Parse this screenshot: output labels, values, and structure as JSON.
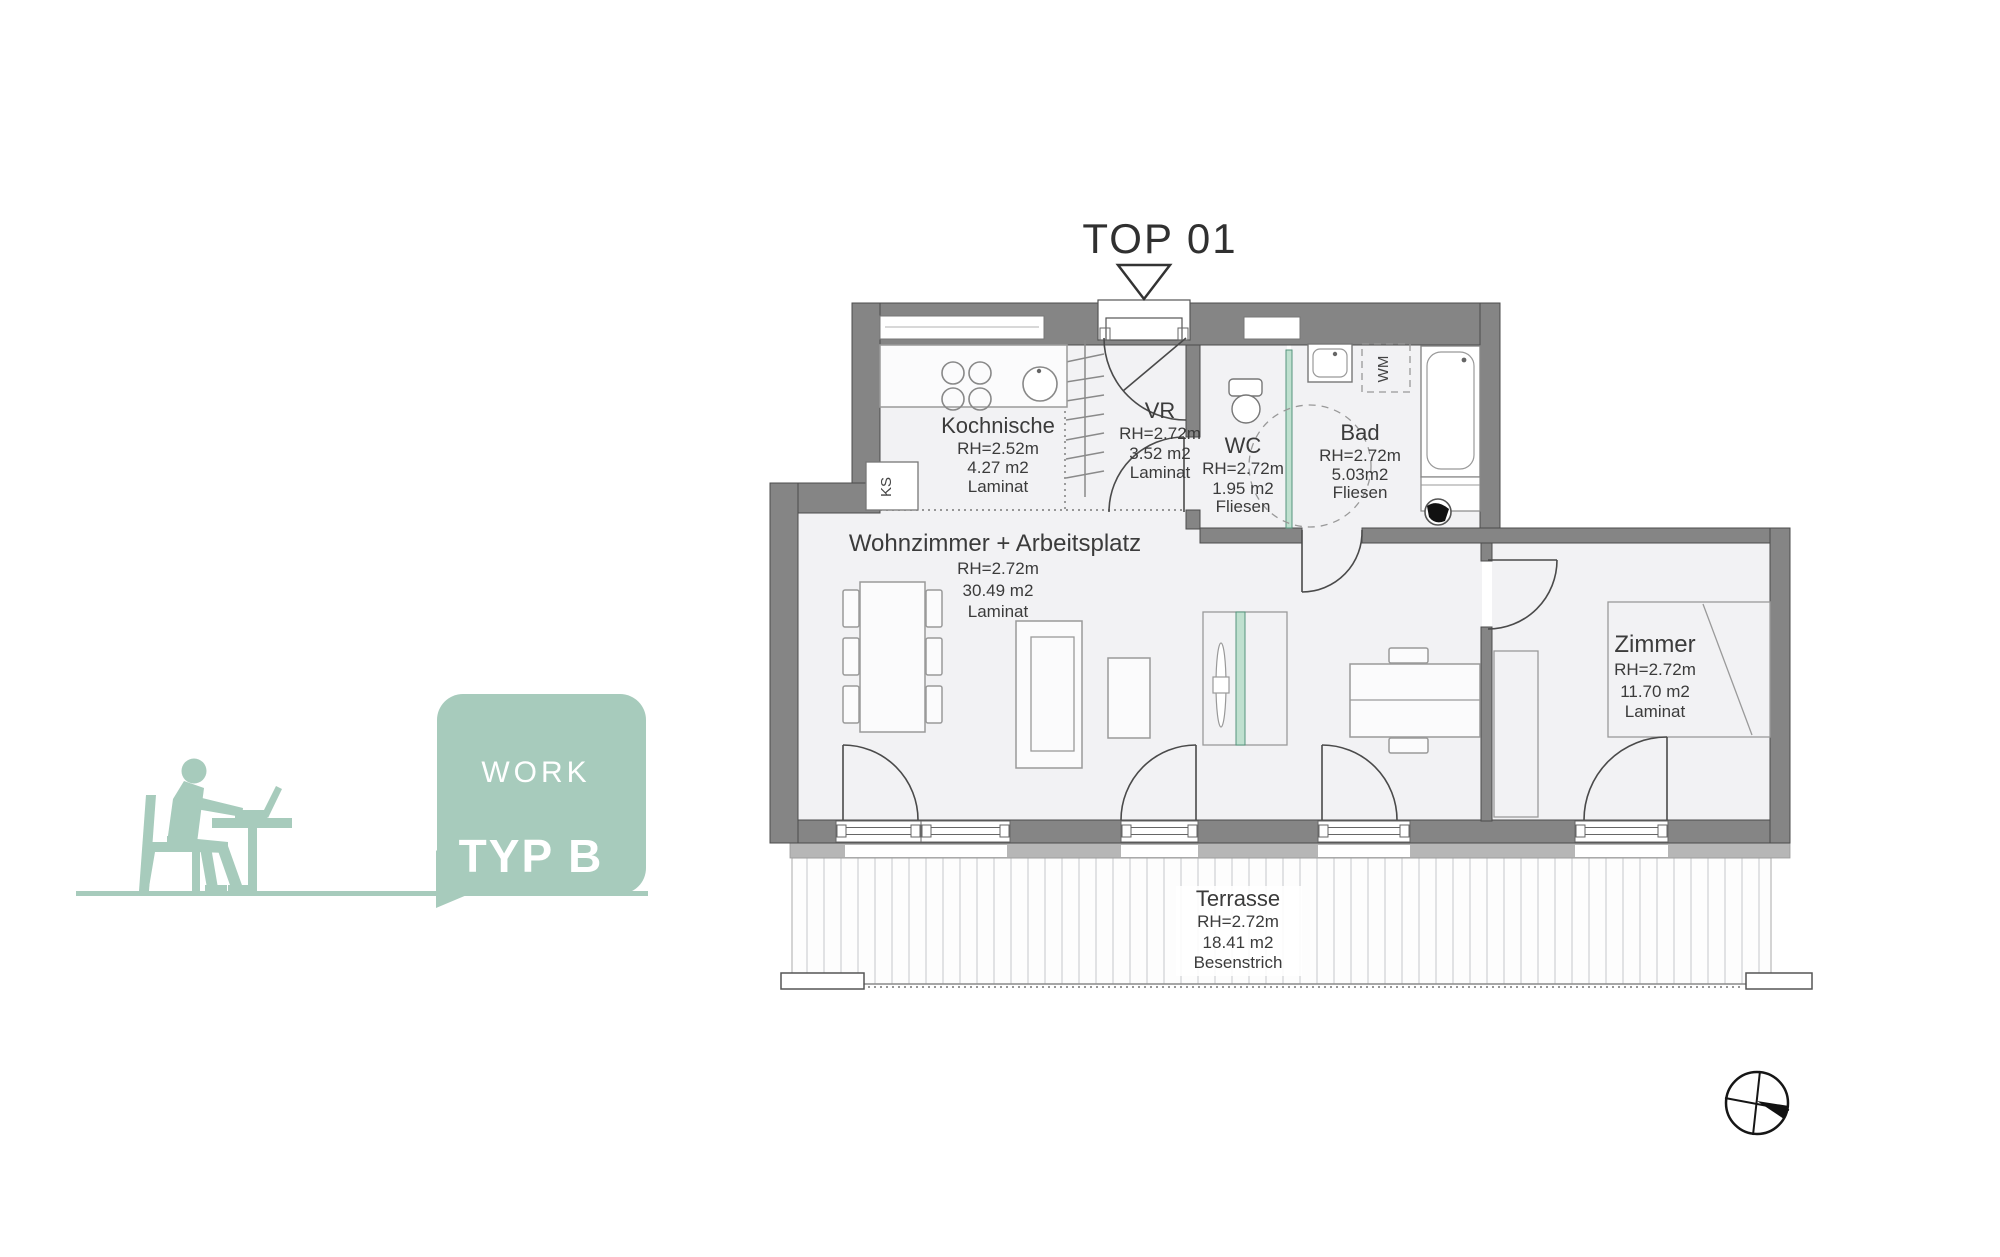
{
  "title": "TOP 01",
  "badge": {
    "category": "WORK",
    "type": "TYP B"
  },
  "rooms": [
    {
      "name": "Kochnische",
      "rh": "RH=2.52m",
      "area": "4.27 m2",
      "floor": "Laminat"
    },
    {
      "name": "VR",
      "rh": "RH=2.72m",
      "area": "3.52 m2",
      "floor": "Laminat"
    },
    {
      "name": "WC",
      "rh": "RH=2.72m",
      "area": "1.95 m2",
      "floor": "Fliesen"
    },
    {
      "name": "Bad",
      "rh": "RH=2.72m",
      "area": "5.03m2",
      "floor": "Fliesen"
    },
    {
      "name": "Wohnzimmer + Arbeitsplatz",
      "rh": "RH=2.72m",
      "area": "30.49 m2",
      "floor": "Laminat"
    },
    {
      "name": "Zimmer",
      "rh": "RH=2.72m",
      "area": "11.70 m2",
      "floor": "Laminat"
    },
    {
      "name": "Terrasse",
      "rh": "RH=2.72m",
      "area": "18.41 m2",
      "floor": "Besenstrich"
    }
  ],
  "fixtures": {
    "fridge": "KS",
    "washing_machine": "WM"
  },
  "colors": {
    "accent_green": "#a7cbbc",
    "glass_green": "#bfe0cf",
    "glass_edge": "#56947c",
    "wall_gray": "#858585",
    "outer_band_gray": "#b6b6b6",
    "floor_gray": "#f2f2f4"
  }
}
